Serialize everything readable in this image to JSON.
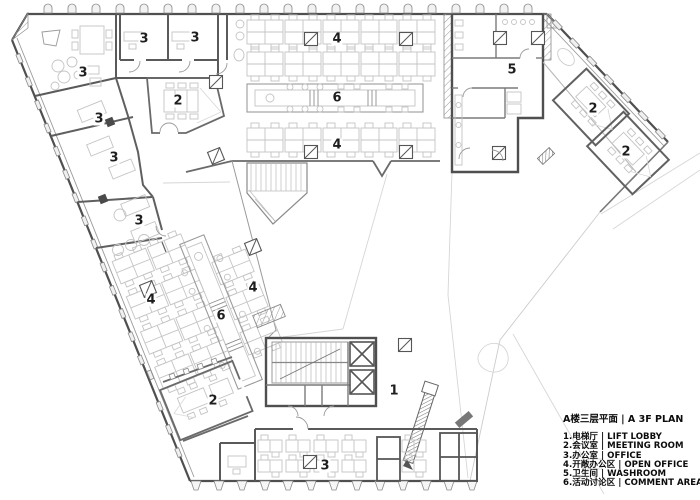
{
  "legend": {
    "title": "A楼三层平面 | A 3F PLAN",
    "items": [
      "1.电梯厅 | LIFT LOBBY",
      "2.会议室 | MEETING ROOM",
      "3.办公室 | OFFICE",
      "4.开敞办公区 | OPEN OFFICE",
      "5.卫生间 | WASHROOM",
      "6.活动讨论区 | COMMENT AREA"
    ]
  },
  "plan": {
    "room_labels": [
      "3",
      "3",
      "3",
      "2",
      "3",
      "3",
      "3",
      "4",
      "6",
      "4",
      "5",
      "2",
      "2",
      "4",
      "4",
      "6",
      "2",
      "3",
      "1"
    ]
  },
  "colors": {
    "wall": "#4f4f4f",
    "wall_medium": "#777777",
    "furniture": "#c4c4c4",
    "faint": "#d9d9d9",
    "label": "#1e1e1e"
  }
}
